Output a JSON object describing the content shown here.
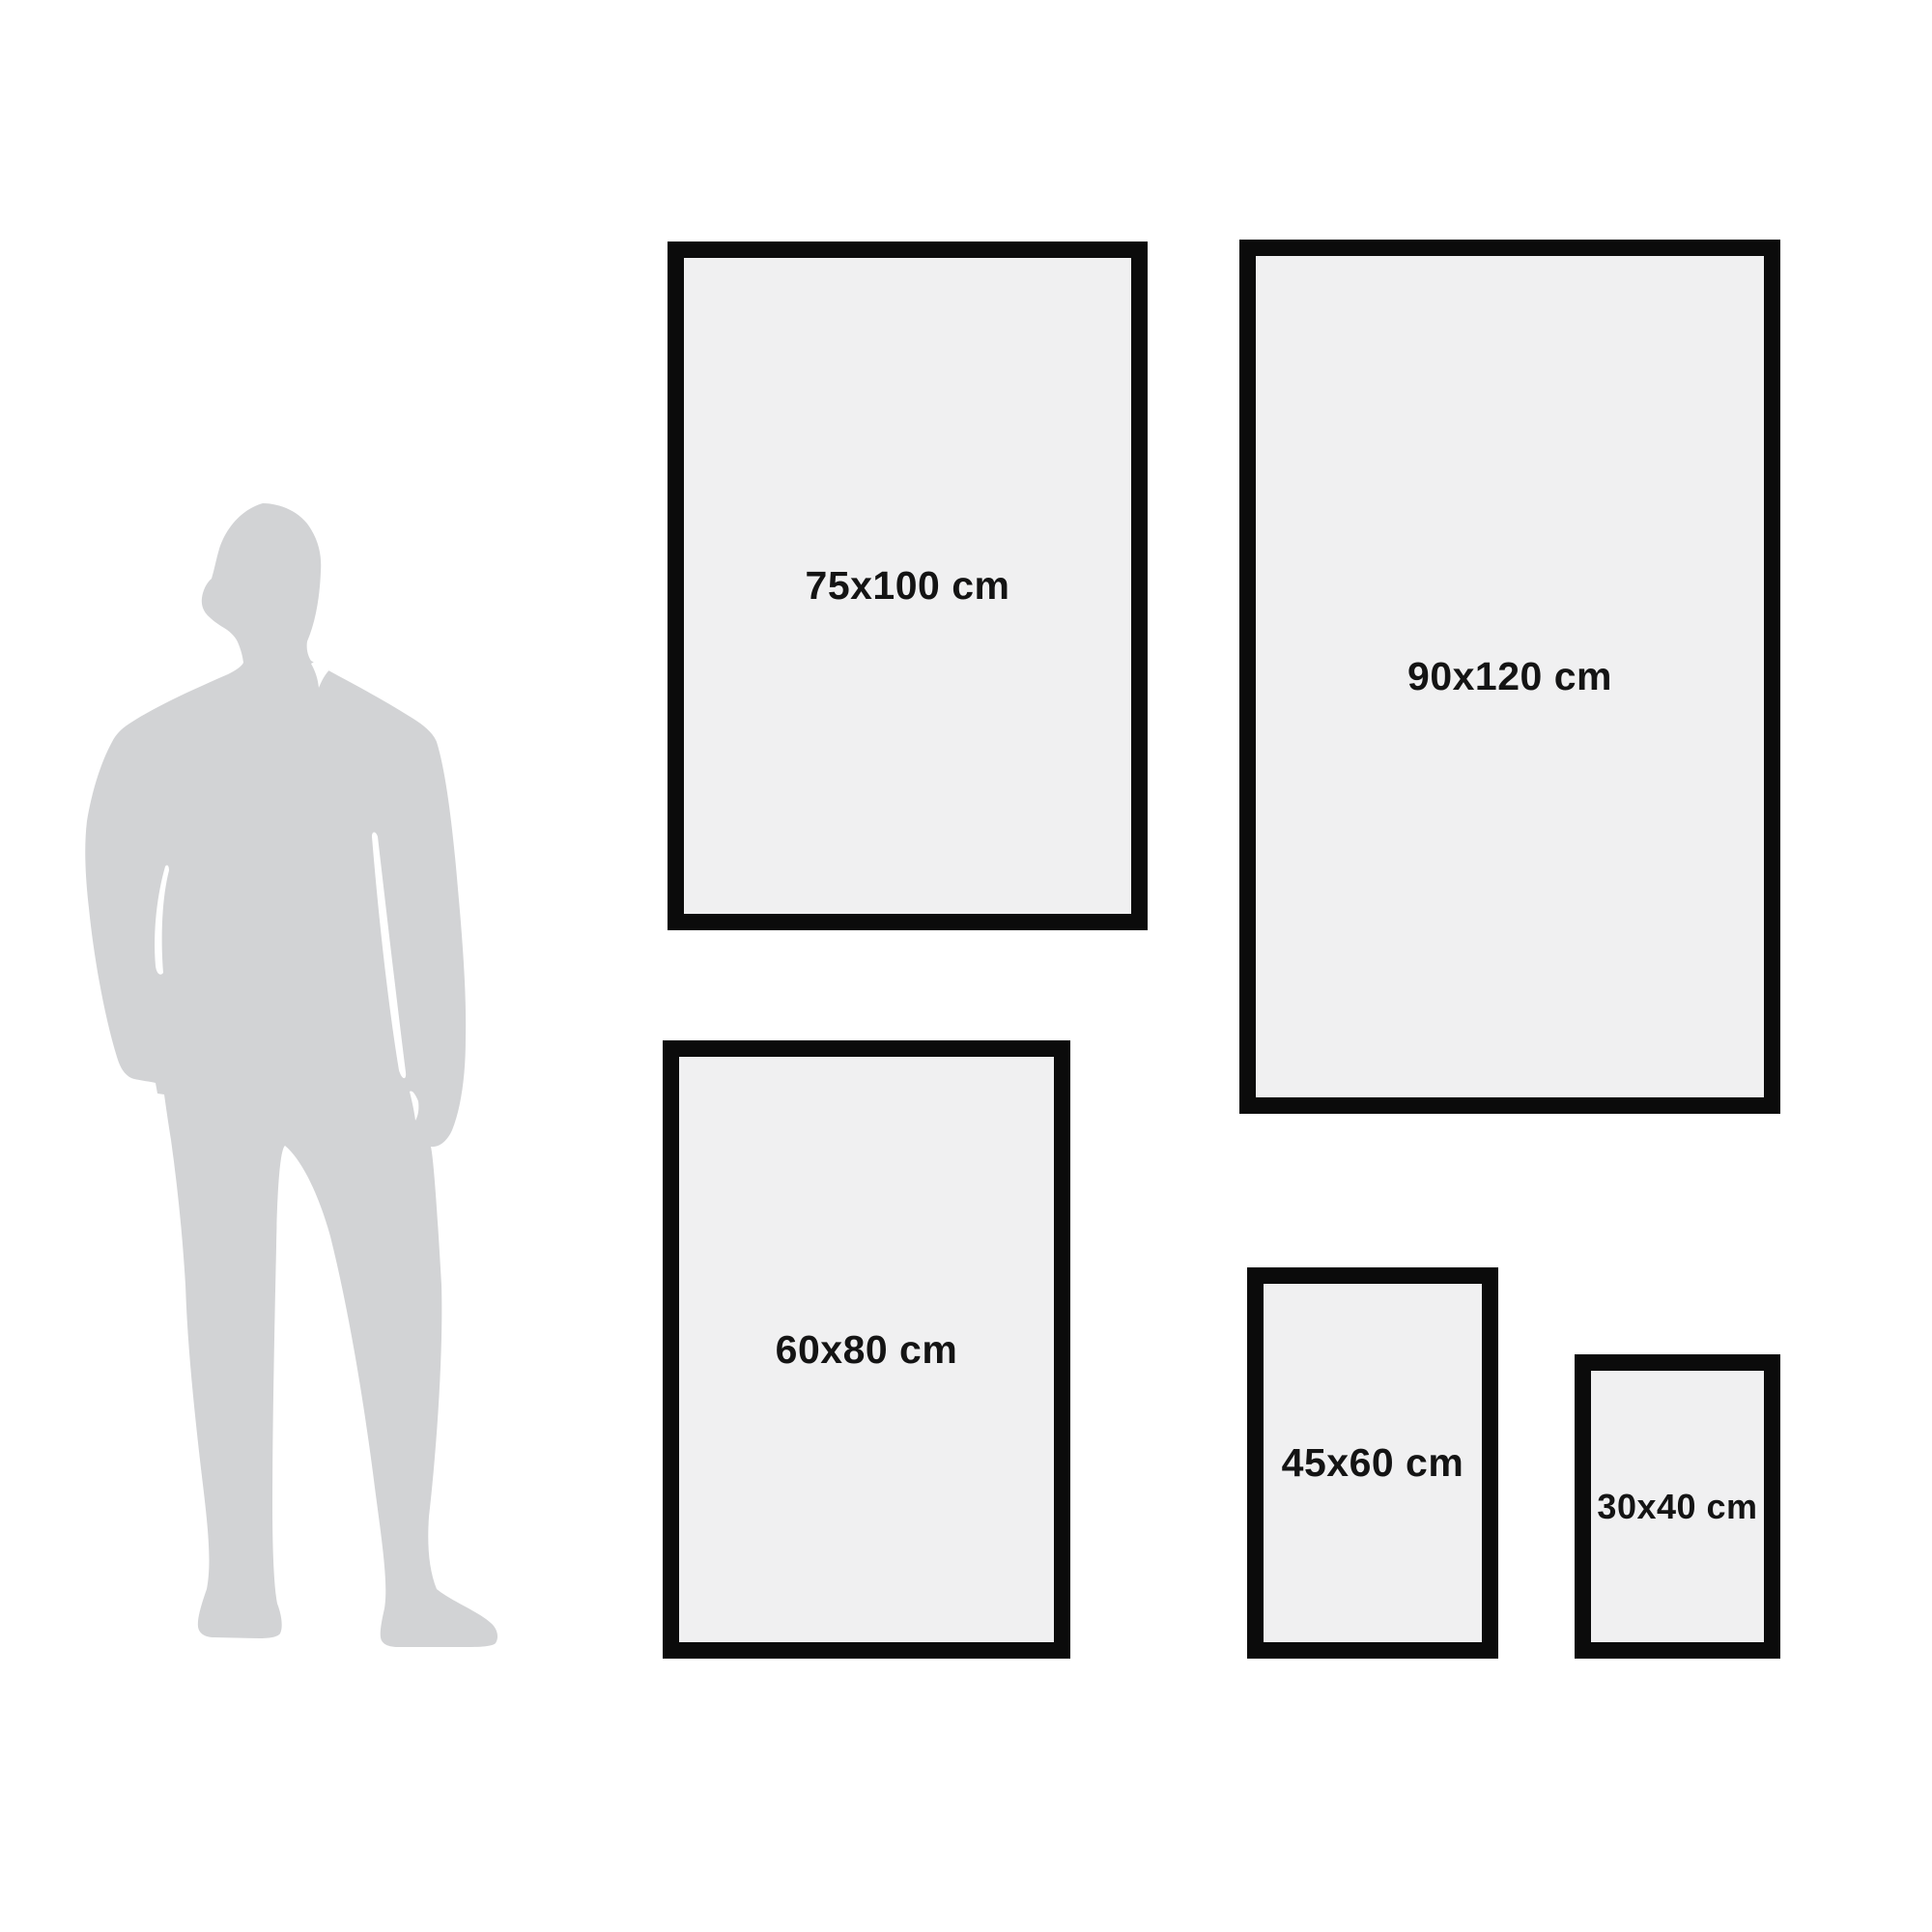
{
  "diagram": {
    "type": "poster-size-comparison",
    "background_color": "#ffffff",
    "frame_border_color": "#0b0b0b",
    "frame_fill_color": "#f0f0f1",
    "silhouette_color": "#d2d3d5",
    "label_color": "#141414",
    "figure": "standing man silhouette for scale",
    "frames": [
      {
        "label": "75x100 cm"
      },
      {
        "label": "90x120 cm"
      },
      {
        "label": "60x80 cm"
      },
      {
        "label": "45x60 cm"
      },
      {
        "label": "30x40 cm"
      }
    ]
  }
}
